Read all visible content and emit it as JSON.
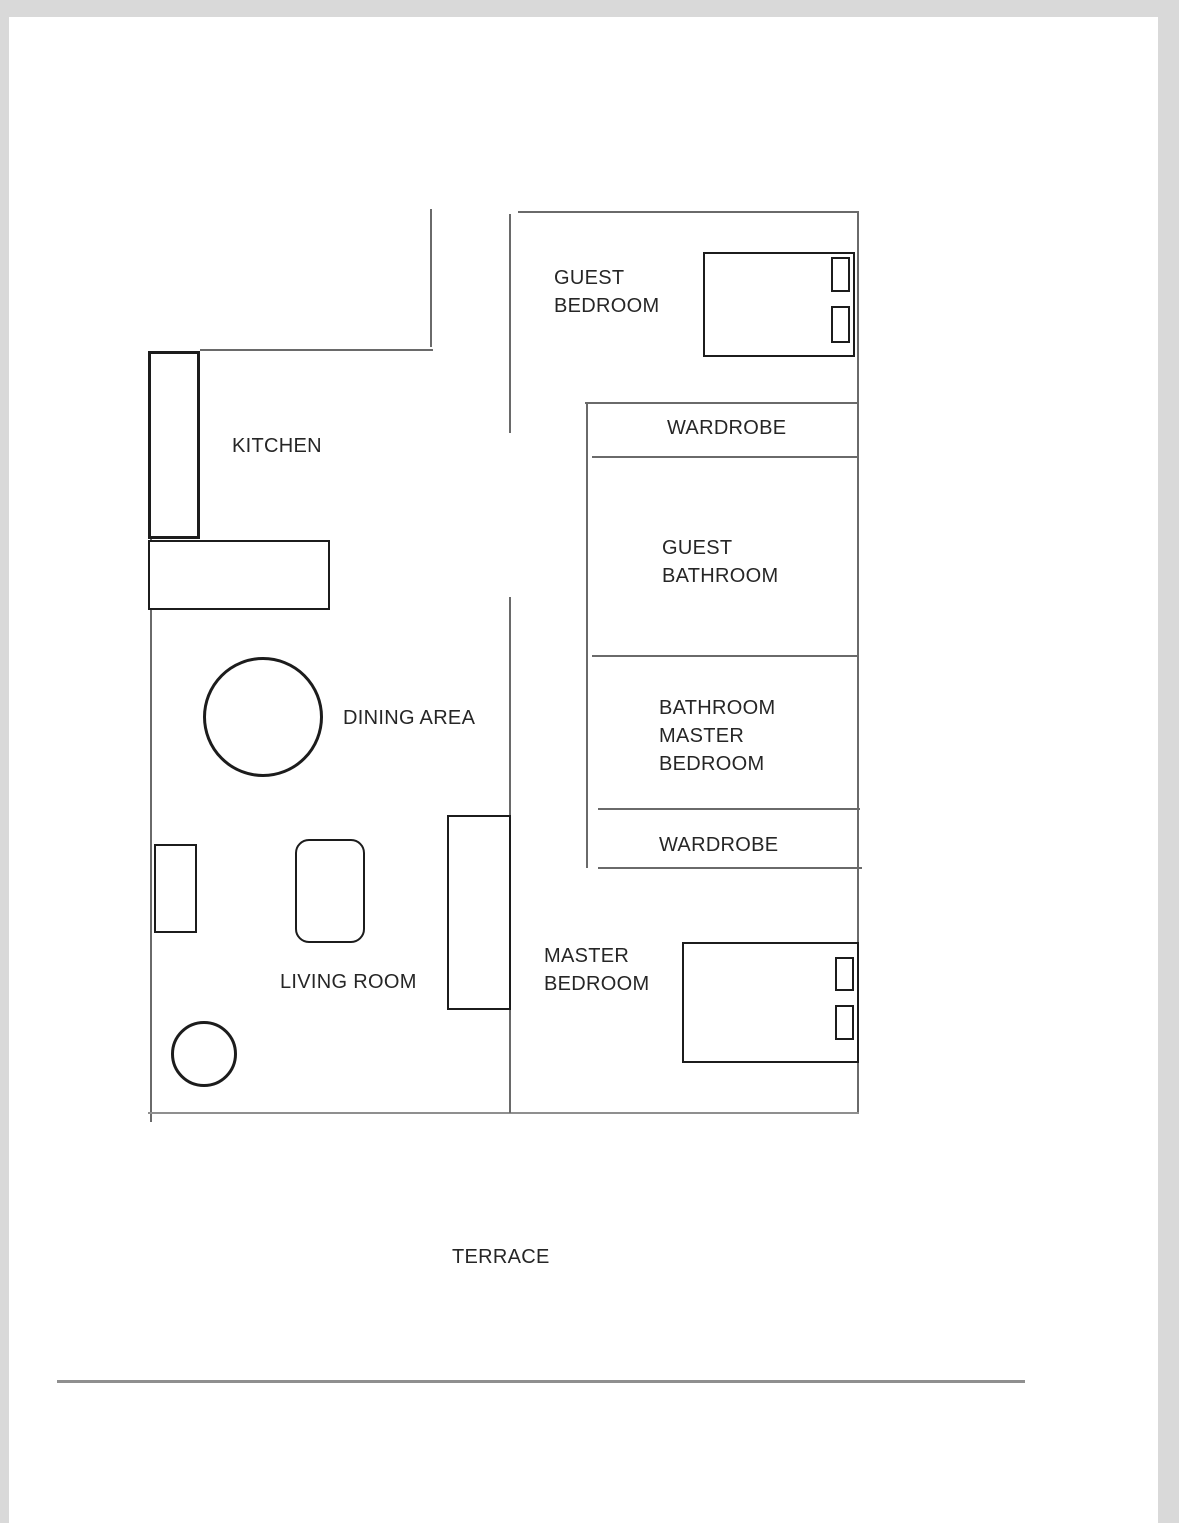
{
  "colors": {
    "background": "#d9d9d9",
    "paper": "#ffffff",
    "wall": "#6a6a6a",
    "wall_light": "#8f8f8f",
    "furniture_outline": "#1c1c1c",
    "text": "#262626"
  },
  "rooms": {
    "guest_bedroom": {
      "lines": [
        "GUEST",
        "BEDROOM"
      ]
    },
    "kitchen": {
      "lines": [
        "KITCHEN"
      ]
    },
    "wardrobe_guest": {
      "lines": [
        "WARDROBE"
      ]
    },
    "guest_bathroom": {
      "lines": [
        "GUEST",
        "BATHROOM"
      ]
    },
    "master_bathroom": {
      "lines": [
        "BATHROOM",
        "MASTER",
        "BEDROOM"
      ]
    },
    "wardrobe_master": {
      "lines": [
        "WARDROBE"
      ]
    },
    "dining_area": {
      "lines": [
        "DINING AREA"
      ]
    },
    "living_room": {
      "lines": [
        "LIVING ROOM"
      ]
    },
    "master_bedroom": {
      "lines": [
        "MASTER",
        "BEDROOM"
      ]
    },
    "terrace": {
      "lines": [
        "TERRACE"
      ]
    }
  },
  "furniture": [
    "guest-bed",
    "guest-bed-pillows",
    "master-bed",
    "master-bed-pillows",
    "kitchen-counter-vertical",
    "kitchen-counter-horizontal",
    "dining-table",
    "living-side-table",
    "living-armchair",
    "living-sofa",
    "living-lamp"
  ]
}
